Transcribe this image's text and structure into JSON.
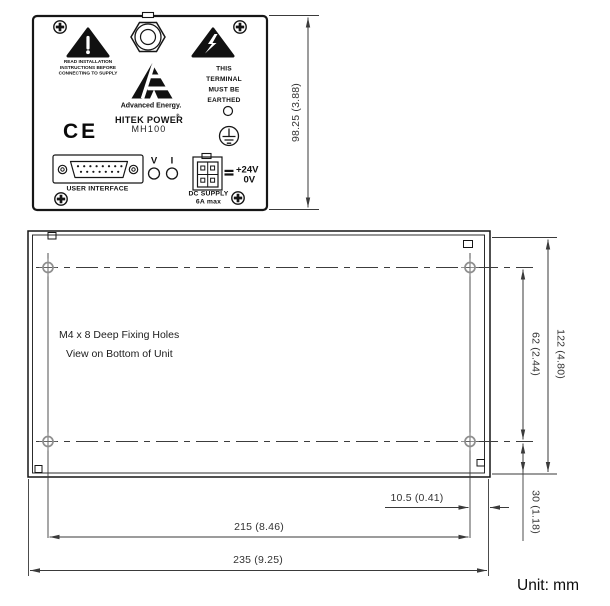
{
  "colors": {
    "ink": "#161616",
    "dimension_lines": "#3a3a3a",
    "background": "#ffffff",
    "hole_marker": "#8f8f8f"
  },
  "front_panel": {
    "height_dimension": "98.25 (3.88)",
    "warning_note_lines": [
      "READ INSTALLATION",
      "INSTRUCTIONS BEFORE",
      "CONNECTING TO SUPPLY"
    ],
    "earth_note_lines": [
      "THIS",
      "TERMINAL",
      "MUST BE",
      "EARTHED"
    ],
    "brand": {
      "name": "Advanced Energy.",
      "product": "HITEK POWER",
      "trademark": "®",
      "model": "MH100",
      "ce_mark": "CE"
    },
    "indicators": {
      "voltage": "V",
      "current": "I"
    },
    "dc_supply": {
      "positive": "+24V",
      "negative": "0V",
      "label": "DC SUPPLY",
      "rating": "6A max"
    },
    "user_interface_label": "USER INTERFACE",
    "icons": {
      "left_triangle": "general-warning-triangle",
      "right_triangle": "high-voltage-warning-triangle",
      "top_center": "cable-gland",
      "earth_symbol": "protective-earth-terminal",
      "corner_fasteners": "phillips-screw"
    }
  },
  "bottom_view": {
    "note_lines": [
      "M4 x 8 Deep Fixing Holes",
      "View on Bottom of Unit"
    ],
    "dimensions": {
      "overall_height": "122 (4.80)",
      "hole_vertical_spacing": "62 (2.44)",
      "hole_bottom_offset": "30 (1.18)",
      "hole_right_offset": "10.5 (0.41)",
      "hole_horizontal_spacing": "215 (8.46)",
      "overall_width": "235 (9.25)"
    }
  },
  "unit_label": "Unit: mm"
}
